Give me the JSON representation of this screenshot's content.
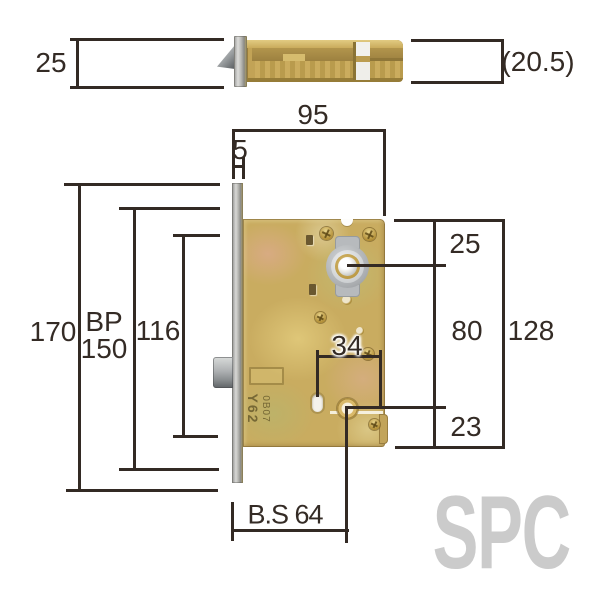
{
  "labels": {
    "side_height": "25",
    "side_depth": "(20.5)",
    "body_width": "95",
    "faceplate_offset": "5",
    "faceplate_height": "170",
    "bp_prefix": "BP",
    "bp_value": "150",
    "screw_span": "116",
    "top_to_cylinder": "25",
    "cylinder_to_lower_hole": "80",
    "lower_hole_to_bottom": "23",
    "case_height": "128",
    "hub_width": "34",
    "backset": "B.S 64"
  },
  "stamp": {
    "large": "Y62",
    "small": "0B07"
  },
  "watermark": "SPC",
  "colors": {
    "dimension_line": "#332a24",
    "label_text": "#342b25",
    "brass_body": "#c9ac60",
    "steel_grey": "#b7babd",
    "watermark_grey": "#cbcbcb",
    "background": "#ffffff"
  }
}
